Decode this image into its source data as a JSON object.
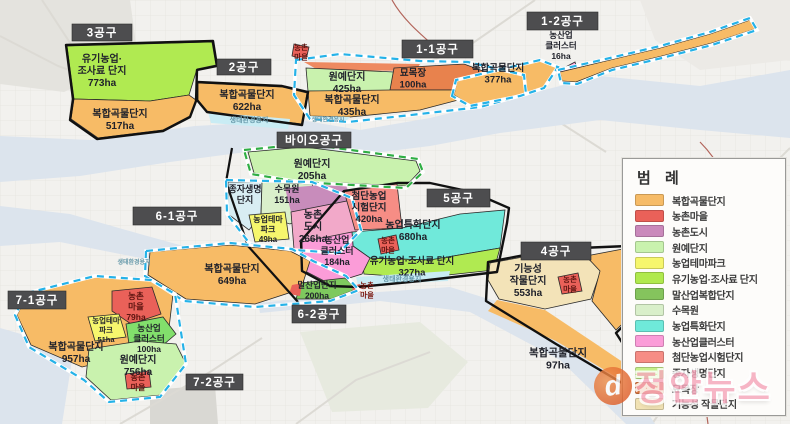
{
  "watermark": {
    "text": "정안뉴스",
    "logo_text": "d"
  },
  "legend": {
    "title": "범 례",
    "items": [
      {
        "label": "복합곡물단지",
        "color": "#f6bb67"
      },
      {
        "label": "농촌마을",
        "color": "#ea6159"
      },
      {
        "label": "농촌도시",
        "color": "#ca89bb"
      },
      {
        "label": "원예단지",
        "color": "#c9f2ae"
      },
      {
        "label": "농업테마파크",
        "color": "#f6f66d"
      },
      {
        "label": "유기농업·조사료 단지",
        "color": "#b0e94e"
      },
      {
        "label": "말산업복합단지",
        "color": "#85c45d"
      },
      {
        "label": "수목원",
        "color": "#d9efca"
      },
      {
        "label": "농업특화단지",
        "color": "#6fe9da"
      },
      {
        "label": "농산업클러스터",
        "color": "#fb9cd8"
      },
      {
        "label": "첨단농업시험단지",
        "color": "#f68d85"
      },
      {
        "label": "종자생명단지",
        "color": "#c6ef8b"
      },
      {
        "label": "묘목장",
        "color": "#e07a42"
      },
      {
        "label": "기능성 작물단지",
        "color": "#f1e2b4"
      }
    ]
  },
  "map": {
    "bg_color": "#f2f1ee",
    "water_color": "#dce4ed",
    "waterways": [
      {
        "name": "river-north",
        "points": "0,136 90,140 195,126 300,120 360,130 430,118 520,96 600,76 700,86 790,70 790,138 700,130 600,120 500,133 430,146 350,156 262,150 170,162 80,176 0,182"
      },
      {
        "name": "river-west-band",
        "points": "0,206 70,214 140,234 205,252 198,268 130,256 60,242 0,246"
      },
      {
        "name": "river-mid",
        "points": "258,303 350,294 450,287 495,301 560,338 625,378 655,424 626,424 560,360 470,312 380,301 300,309 260,313"
      },
      {
        "name": "water-southwest",
        "points": "0,328 42,340 72,360 62,424 0,424"
      }
    ],
    "decor": {
      "patches": [
        {
          "name": "patch-northwest",
          "color": "#e4e3de",
          "points": "0,0 130,0 138,58 64,92 0,84"
        },
        {
          "name": "patch-northeast",
          "color": "#eceae6",
          "points": "640,0 790,0 790,60 700,70 655,40"
        },
        {
          "name": "patch-south-green",
          "color": "#e7eadf",
          "points": "300,332 420,322 468,362 428,408 332,412"
        },
        {
          "name": "patch-southwest-dark",
          "color": "#d9d8d3",
          "points": "150,390 215,385 218,424 150,424"
        }
      ],
      "roads": [
        "M535,0 L470,45 L428,62",
        "M0,36 L58,66 L118,88",
        "M42,0 L76,52 L70,118",
        "M120,424 L210,372 L262,338",
        "M296,424 L356,380 L430,352",
        "M652,424 L696,360 L730,300 L744,228",
        "M790,148 L742,196 L706,256",
        "M556,120 L606,152"
      ],
      "boundaries": [
        "M392,0 C402,18 418,32 434,46",
        "M700,142 C738,180 748,240 720,300 C708,334 700,372 708,424"
      ],
      "black_lines": [
        "M232,148 L226,182 L248,246 L298,302"
      ]
    },
    "zones": [
      {
        "name": "zone-organic-fodder-773",
        "color": "#b0ea51",
        "points": "67,46 212,42 216,65 197,69 189,95 150,101 74,99",
        "label": {
          "x": 102,
          "y": 62,
          "size": 10,
          "lines": [
            "유기농업·",
            "조사료 단지",
            "773ha"
          ]
        }
      },
      {
        "name": "zone-grain-517",
        "color": "#f7bb66",
        "points": "74,99 150,101 189,95 196,100 190,116 163,130 98,138 71,119",
        "label": {
          "x": 120,
          "y": 117,
          "size": 10,
          "lines": [
            "복합곡물단지",
            "517ha"
          ]
        }
      },
      {
        "name": "zone-grain-622",
        "color": "#f7bb66",
        "points": "198,83 282,87 307,93 302,124 208,112 198,100",
        "label": {
          "x": 247,
          "y": 98,
          "size": 10,
          "lines": [
            "복합곡물단지",
            "622ha"
          ]
        }
      },
      {
        "name": "zone-eco-strip-2",
        "color": "#c9ecf4",
        "sw": 0,
        "points": "208,112 290,119 288,129 211,123",
        "label": {
          "x": 249,
          "y": 122,
          "size": 7,
          "color": "#689aab",
          "lines": [
            "생태환경용지"
          ]
        }
      },
      {
        "name": "zone-village-north",
        "color": "#ea6159",
        "points": "294,44 309,47 306,60 292,56",
        "label": {
          "x": 301,
          "y": 50,
          "size": 7.5,
          "color": "#5c1410",
          "lines": [
            "농촌",
            "마을"
          ]
        }
      },
      {
        "name": "zone-strip-1-1-top",
        "color": "#ee8a60",
        "sw": 0,
        "points": "304,62 420,64 416,71 318,70"
      },
      {
        "name": "zone-horticulture-425",
        "color": "#c9f2ae",
        "points": "306,68 394,72 390,91 308,91",
        "label": {
          "x": 347,
          "y": 80,
          "size": 10,
          "lines": [
            "원예단지",
            "425ha"
          ]
        }
      },
      {
        "name": "zone-nursery-100",
        "color": "#e8824d",
        "points": "394,68 464,64 502,78 458,90 390,90",
        "label": {
          "x": 413,
          "y": 76,
          "size": 9.5,
          "lines": [
            "묘목장",
            "100ha"
          ]
        }
      },
      {
        "name": "zone-horticulture-tip",
        "color": "#c9f2ae",
        "sw": 0,
        "points": "458,90 502,78 522,88 462,99"
      },
      {
        "name": "zone-grain-435",
        "color": "#f7bb66",
        "points": "308,91 390,90 458,90 462,99 420,110 350,117 310,116",
        "label": {
          "x": 352,
          "y": 103,
          "size": 10,
          "lines": [
            "복합곡물단지",
            "435ha"
          ]
        }
      },
      {
        "name": "zone-eco-strip-1-1",
        "color": "#c9ecf4",
        "sw": 0,
        "points": "310,116 350,117 344,123 312,121",
        "label": {
          "x": 328,
          "y": 121.5,
          "size": 6,
          "color": "#689aab",
          "lines": [
            "생태환경용지"
          ]
        }
      },
      {
        "name": "zone-grain-377",
        "color": "#f7bb66",
        "points": "454,95 457,81 540,61 558,68 544,87 520,95 470,105",
        "label": {
          "x": 498,
          "y": 71,
          "size": 9.5,
          "lines": [
            "복합곡물단지",
            "377ha"
          ]
        }
      },
      {
        "name": "zone-cluster-16",
        "color": "#fb9cd8",
        "points": "560,70 575,62 578,73 565,81"
      },
      {
        "name": "zone-grain-strip-1-2",
        "color": "#f7bb66",
        "points": "560,72 610,60 660,48 710,34 750,20 755,29 712,43 662,56 612,68 576,82 562,81"
      },
      {
        "name": "zone-horticulture-205",
        "color": "#c9f2ae",
        "points": "248,152 304,147 416,161 420,171 406,186 300,181 254,173",
        "label": {
          "x": 312,
          "y": 167,
          "size": 10,
          "lines": [
            "원예단지",
            "205ha"
          ]
        }
      },
      {
        "name": "zone-seed-life",
        "color": "#d8edf3",
        "points": "228,182 262,182 261,215 249,230 228,214",
        "label": {
          "x": 245,
          "y": 192,
          "size": 9,
          "lines": [
            "종자생명",
            "단지"
          ]
        }
      },
      {
        "name": "zone-arboretum-151",
        "color": "#daefcb",
        "points": "262,182 312,184 320,210 290,224 261,215",
        "label": {
          "x": 287,
          "y": 192,
          "size": 9,
          "lines": [
            "수목원",
            "151ha"
          ]
        }
      },
      {
        "name": "zone-theme-park-49",
        "color": "#f6f66d",
        "points": "249,215 285,212 289,239 255,242",
        "label": {
          "x": 268,
          "y": 222,
          "size": 8,
          "lines": [
            "농업테마",
            "파크",
            "49ha"
          ]
        }
      },
      {
        "name": "zone-rural-city-upper",
        "color": "#c88cbb",
        "sw": 0,
        "points": "285,188 345,183 352,200 291,212"
      },
      {
        "name": "zone-rural-city-266",
        "color": "#f2a9c9",
        "points": "291,212 352,200 360,229 339,251 294,249",
        "label": {
          "x": 313,
          "y": 218,
          "size": 10,
          "lines": [
            "농촌",
            "도시",
            "266ha"
          ]
        }
      },
      {
        "name": "zone-hightech-420",
        "color": "#f68d85",
        "points": "344,191 397,184 402,228 355,230",
        "label": {
          "x": 369,
          "y": 199,
          "size": 9.5,
          "lines": [
            "첨단농업",
            "시험단지",
            "420ha"
          ]
        }
      },
      {
        "name": "zone-special-680",
        "color": "#70e9da",
        "points": "352,232 402,228 460,214 505,210 500,248 430,260 370,258 353,246",
        "label": {
          "x": 413,
          "y": 228,
          "size": 10,
          "lines": [
            "농업특화단지",
            "680ha"
          ]
        }
      },
      {
        "name": "zone-organic-327",
        "color": "#b0ea51",
        "points": "362,258 430,260 500,248 494,270 420,278 364,274",
        "label": {
          "x": 412,
          "y": 264,
          "size": 9.5,
          "lines": [
            "유기농업·조사료 단지",
            "327ha"
          ]
        }
      },
      {
        "name": "zone-cluster-184",
        "color": "#fb9cd8",
        "points": "302,242 352,232 353,246 370,258 362,274 330,284 303,270",
        "label": {
          "x": 337,
          "y": 243,
          "size": 9,
          "lines": [
            "농산업",
            "클러스터",
            "184ha"
          ]
        }
      },
      {
        "name": "zone-village-5",
        "color": "#ea6159",
        "points": "378,239 396,235 399,250 381,254",
        "label": {
          "x": 388,
          "y": 243,
          "size": 7.5,
          "color": "#5c1410",
          "lines": [
            "농촌",
            "마을"
          ]
        }
      },
      {
        "name": "zone-eco-strip-5",
        "color": "#c9ecf4",
        "sw": 0,
        "points": "356,277 450,271 448,281 358,285",
        "label": {
          "x": 402,
          "y": 281,
          "size": 7,
          "color": "#689aab",
          "lines": [
            "생태환경용지"
          ]
        }
      },
      {
        "name": "zone-grain-649",
        "color": "#f7bb66",
        "points": "150,252 230,245 290,251 310,261 301,289 255,304 186,299 148,275",
        "label": {
          "x": 232,
          "y": 272,
          "size": 10,
          "lines": [
            "복합곡물단지",
            "649ha"
          ]
        }
      },
      {
        "name": "zone-horse-200",
        "color": "#7ec95e",
        "points": "301,283 345,278 357,289 331,299 296,299",
        "label": {
          "x": 317,
          "y": 288,
          "size": 8.5,
          "lines": [
            "말산업단지",
            "200ha"
          ]
        }
      },
      {
        "name": "zone-horse-tip",
        "color": "#ea6159",
        "sw": 0,
        "points": "292,285 302,283 300,296 289,294"
      },
      {
        "name": "zone-village-dot-6-2",
        "color": "#ea6159",
        "sw": 0,
        "points": "352,286 360,284 361,292 353,293"
      },
      {
        "name": "zone-grain-957",
        "color": "#f7bb66",
        "points": "28,294 95,277 150,281 173,294 169,328 136,354 82,367 31,345 17,315",
        "label": {
          "x": 76,
          "y": 350,
          "size": 10,
          "lines": [
            "복합곡물단지",
            "957ha"
          ]
        }
      },
      {
        "name": "zone-village-79",
        "color": "#ea6159",
        "points": "112,291 152,287 161,314 131,324 112,311",
        "label": {
          "x": 136,
          "y": 299,
          "size": 8.5,
          "color": "#5c1410",
          "lines": [
            "농촌",
            "마을",
            "79ha"
          ]
        }
      },
      {
        "name": "zone-theme-park-51",
        "color": "#f6f66d",
        "points": "88,317 119,314 126,337 95,341",
        "label": {
          "x": 106,
          "y": 323,
          "size": 7.5,
          "lines": [
            "농업테마",
            "파크",
            "51ha"
          ]
        }
      },
      {
        "name": "zone-cluster-100",
        "color": "#82df6c",
        "points": "126,324 163,317 176,334 156,351 129,344",
        "label": {
          "x": 149,
          "y": 331,
          "size": 8.5,
          "lines": [
            "농산업",
            "클러스터",
            "100ha"
          ]
        }
      },
      {
        "name": "zone-horticulture-756",
        "color": "#c9f2ae",
        "points": "89,349 140,341 176,344 186,364 161,395 111,400 86,377",
        "label": {
          "x": 138,
          "y": 363,
          "size": 10,
          "lines": [
            "원예단지",
            "756ha"
          ]
        }
      },
      {
        "name": "zone-village-756",
        "color": "#ea6159",
        "points": "125,374 149,371 151,387 127,389",
        "label": {
          "x": 138,
          "y": 380,
          "size": 8,
          "color": "#5c1410",
          "lines": [
            "농촌",
            "마을"
          ]
        }
      },
      {
        "name": "zone-functional-553",
        "color": "#f3e3b8",
        "points": "490,263 556,251 586,257 601,270 591,299 545,309 499,299 488,280",
        "label": {
          "x": 528,
          "y": 272,
          "size": 10,
          "lines": [
            "기능성",
            "작물단지",
            "553ha"
          ]
        }
      },
      {
        "name": "zone-village-4",
        "color": "#ea6159",
        "points": "558,277 578,273 582,291 562,294",
        "label": {
          "x": 570,
          "y": 282,
          "size": 7.5,
          "color": "#5c1410",
          "lines": [
            "농촌",
            "마을"
          ]
        }
      },
      {
        "name": "zone-grain-4-east",
        "color": "#f7bb66",
        "points": "586,256 628,248 648,262 642,305 616,330 592,301 600,271"
      },
      {
        "name": "zone-grain-4-strip",
        "color": "#f7bb66",
        "sw": 0,
        "points": "497,300 545,310 596,344 630,367 618,378 556,341 488,311"
      }
    ],
    "floating_labels": [
      {
        "name": "label-cluster-16",
        "x": 561,
        "y": 38,
        "size": 8.5,
        "lines": [
          "농산업",
          "클러스터",
          "16ha"
        ]
      },
      {
        "name": "label-grain-97",
        "x": 558,
        "y": 356,
        "size": 10.5,
        "lines": [
          "복합곡물단지",
          "97ha"
        ]
      },
      {
        "name": "label-village-horse",
        "x": 367,
        "y": 288,
        "size": 7.5,
        "color": "#7a150c",
        "lines": [
          "농촌",
          "마을"
        ]
      },
      {
        "name": "label-eco-west",
        "x": 134,
        "y": 264,
        "size": 6,
        "color": "#689aab",
        "lines": [
          "생태환경용지"
        ]
      }
    ],
    "outlines": [
      {
        "name": "district-3-outline",
        "style": "black",
        "points": "66,45 213,41 217,66 197,70 196,101 190,117 163,131 97,139 70,120 73,99"
      },
      {
        "name": "district-2-outline",
        "style": "black",
        "points": "197,82 282,86 308,92 302,125 207,112 197,100"
      },
      {
        "name": "district-5-outline",
        "style": "black",
        "points": "301,241 344,191 397,183 430,183 472,192 509,208 507,223 497,272 420,281 358,287 330,286 302,271"
      },
      {
        "name": "district-4-outline",
        "style": "black",
        "points": "488,262 556,249 628,246 651,261 643,307 616,333 639,369 622,383 556,344 486,301"
      },
      {
        "name": "district-1-1-outline",
        "style": "cyan-dash",
        "points": "296,60 340,54 420,61 468,62 524,75 526,94 480,107 420,114 348,122 310,119 294,95"
      },
      {
        "name": "district-377-outline",
        "style": "cyan-dash",
        "points": "452,96 456,80 540,60 558,67 544,88 520,96 470,106"
      },
      {
        "name": "district-1-2-outline",
        "style": "cyan-dash",
        "points": "558,70 610,58 660,46 710,32 750,18 757,30 712,45 662,58 612,70 577,84 561,83"
      },
      {
        "name": "bio-outline",
        "style": "green-dash",
        "points": "244,150 306,144 418,159 423,172 406,188 300,182 251,174"
      },
      {
        "name": "seed-zone-outline",
        "style": "cyan-dash",
        "points": "226,180 312,182 352,198 361,230 339,253 294,250 250,244 227,214"
      },
      {
        "name": "district-6-1-outline",
        "style": "cyan-dash",
        "points": "146,251 230,243 292,249 313,261 346,276 359,290 330,301 255,307 184,301 145,276"
      },
      {
        "name": "district-7-1-outline",
        "style": "cyan-dash",
        "points": "27,293 95,276 151,280 175,294 186,364 160,397 109,402 84,380 29,347 15,315"
      }
    ],
    "sections": [
      {
        "label": "3공구",
        "x": 72,
        "y": 24,
        "w": 60,
        "h": 17
      },
      {
        "label": "2공구",
        "x": 217,
        "y": 59,
        "w": 54,
        "h": 16
      },
      {
        "label": "1-1공구",
        "x": 402,
        "y": 40,
        "w": 71,
        "h": 18
      },
      {
        "label": "1-2공구",
        "x": 527,
        "y": 12,
        "w": 71,
        "h": 18
      },
      {
        "label": "바이오공구",
        "x": 277,
        "y": 132,
        "w": 74,
        "h": 16
      },
      {
        "label": "5공구",
        "x": 427,
        "y": 189,
        "w": 63,
        "h": 18
      },
      {
        "label": "4공구",
        "x": 521,
        "y": 242,
        "w": 70,
        "h": 18
      },
      {
        "label": "6-1공구",
        "x": 133,
        "y": 207,
        "w": 88,
        "h": 18
      },
      {
        "label": "6-2공구",
        "x": 292,
        "y": 305,
        "w": 54,
        "h": 18
      },
      {
        "label": "7-1공구",
        "x": 8,
        "y": 291,
        "w": 58,
        "h": 18
      },
      {
        "label": "7-2공구",
        "x": 186,
        "y": 374,
        "w": 57,
        "h": 16
      }
    ]
  }
}
